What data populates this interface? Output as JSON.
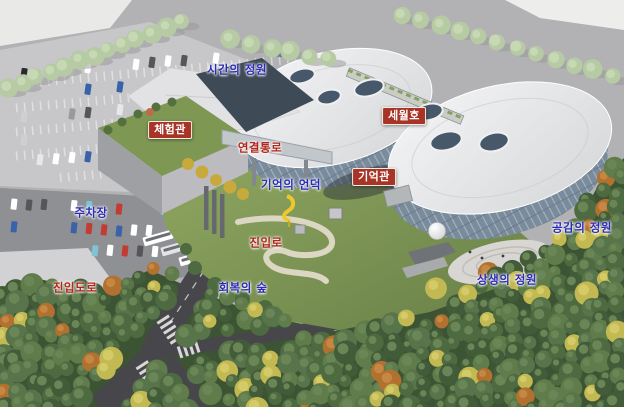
{
  "labels": [
    {
      "id": "garden-of-time",
      "text": "시간의 정원",
      "type": "blue",
      "x": 237,
      "y": 70
    },
    {
      "id": "experience-hall",
      "text": "체험관",
      "type": "box",
      "x": 170,
      "y": 130
    },
    {
      "id": "sewol-ferry",
      "text": "세월호",
      "type": "box",
      "x": 404,
      "y": 116
    },
    {
      "id": "connecting-passage",
      "text": "연결통로",
      "type": "red",
      "x": 260,
      "y": 148
    },
    {
      "id": "memorial-hall",
      "text": "기억관",
      "type": "box",
      "x": 374,
      "y": 177
    },
    {
      "id": "hill-of-memory",
      "text": "기억의 언덕",
      "type": "blue",
      "x": 291,
      "y": 185
    },
    {
      "id": "parking-lot",
      "text": "주차장",
      "type": "blue",
      "x": 91,
      "y": 213
    },
    {
      "id": "access-road",
      "text": "진입로",
      "type": "red",
      "x": 266,
      "y": 243
    },
    {
      "id": "forest-of-recovery",
      "text": "회복의 숲",
      "type": "blue",
      "x": 243,
      "y": 288
    },
    {
      "id": "entry-road",
      "text": "진입도로",
      "type": "red",
      "x": 75,
      "y": 288
    },
    {
      "id": "garden-of-empathy",
      "text": "공감의 정원",
      "type": "blue",
      "x": 582,
      "y": 228
    },
    {
      "id": "garden-of-coexistence",
      "text": "상생의 정원",
      "type": "blue",
      "x": 507,
      "y": 280
    }
  ],
  "colors": {
    "label_blue": "#2b2bb4",
    "label_red": "#b02618",
    "box_bg": "#a83428",
    "box_border": "#f3ede1",
    "box_text": "#ffffff"
  }
}
